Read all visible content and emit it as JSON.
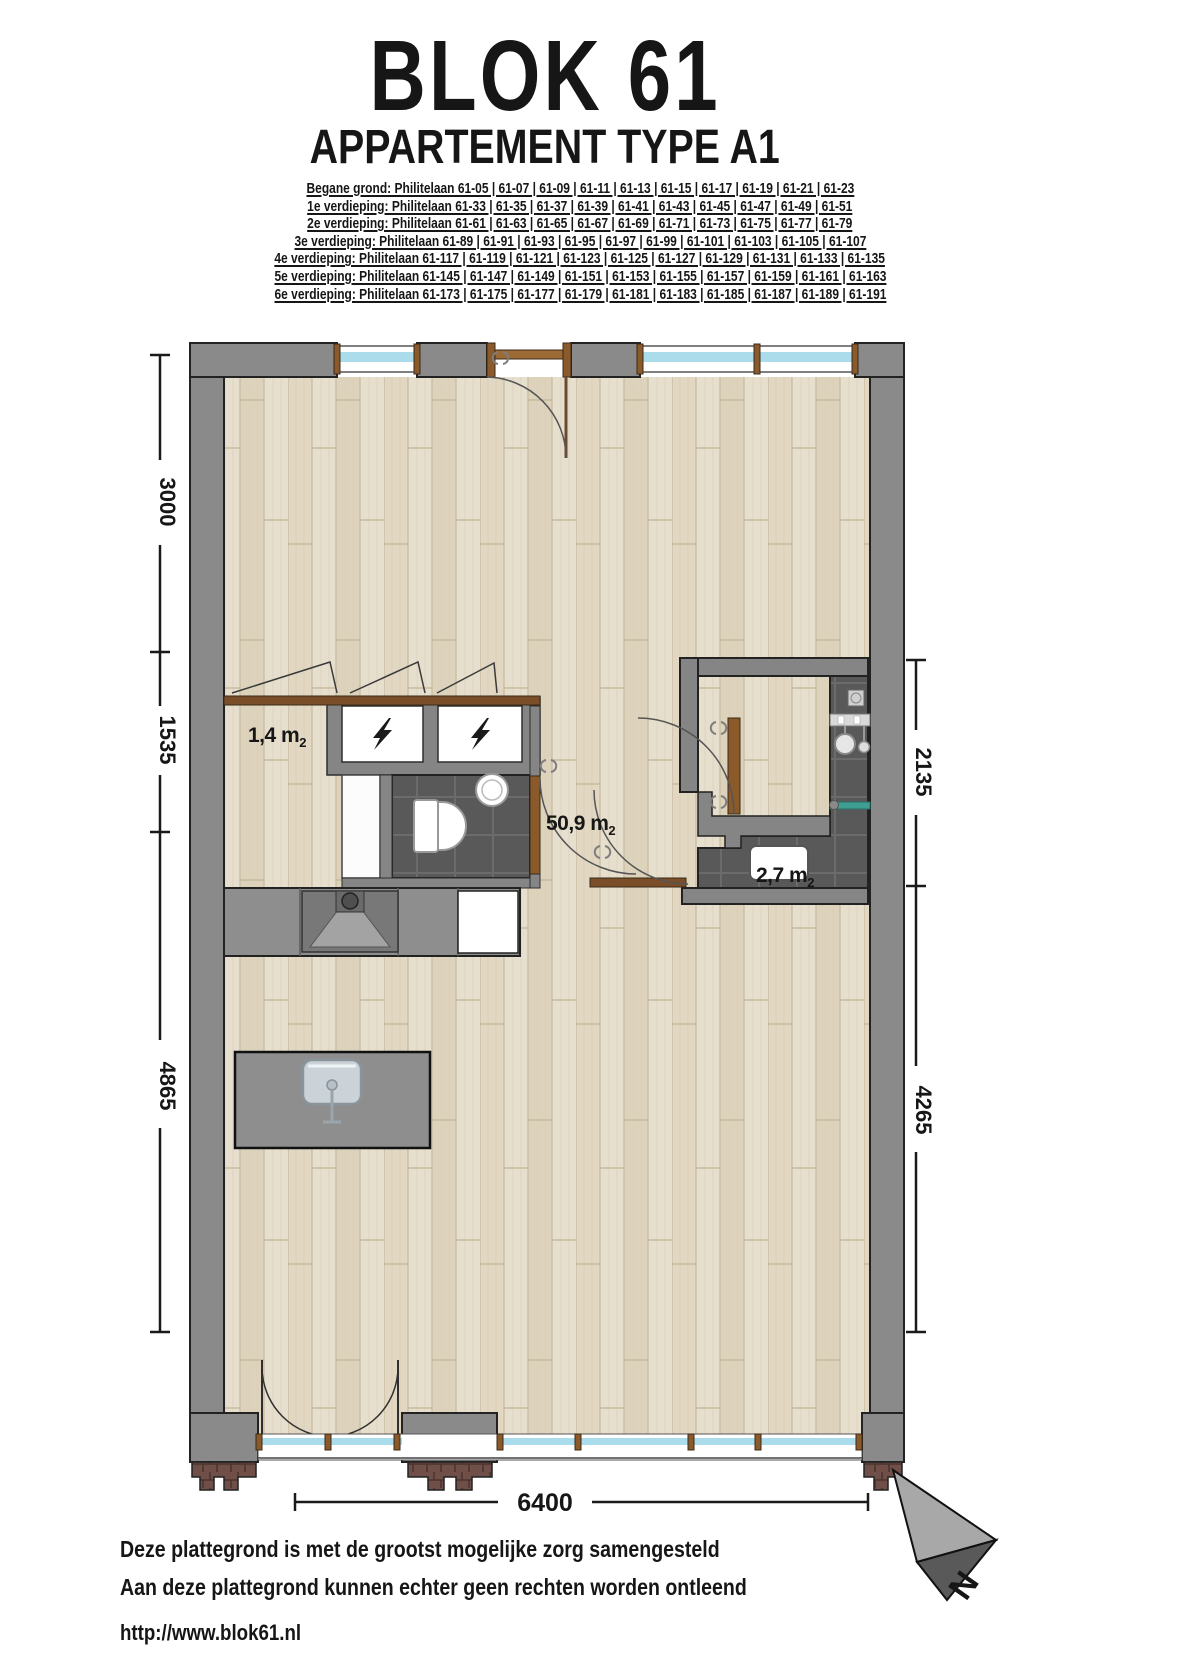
{
  "header": {
    "title": "BLOK 61",
    "subtitle": "APPARTEMENT TYPE A1",
    "address_lines": [
      "Begane grond: Philitelaan 61-05 | 61-07 | 61-09 | 61-11 | 61-13 | 61-15 | 61-17 | 61-19 | 61-21 | 61-23",
      "1e verdieping: Philitelaan 61-33 | 61-35 | 61-37 | 61-39 | 61-41 | 61-43 | 61-45 | 61-47 | 61-49 | 61-51",
      "2e verdieping: Philitelaan 61-61 | 61-63 | 61-65 | 61-67 | 61-69 | 61-71 | 61-73 | 61-75 | 61-77 | 61-79",
      "3e verdieping: Philitelaan 61-89 | 61-91 | 61-93 | 61-95 | 61-97 | 61-99 | 61-101 | 61-103 | 61-105 | 61-107",
      "4e verdieping: Philitelaan 61-117 | 61-119 | 61-121 | 61-123 | 61-125 | 61-127 | 61-129 | 61-131 | 61-133 | 61-135",
      "5e verdieping: Philitelaan 61-145 | 61-147 | 61-149 | 61-151 | 61-153 | 61-155 | 61-157 | 61-159 | 61-161 | 61-163",
      "6e verdieping: Philitelaan 61-173 | 61-175 | 61-177 | 61-179 | 61-181 | 61-183 | 61-185 | 61-187 | 61-189 | 61-191"
    ]
  },
  "plan": {
    "rooms": [
      {
        "name": "berging",
        "area": "1,4 m",
        "sub": "2"
      },
      {
        "name": "woonkamer",
        "area": "50,9 m",
        "sub": "2"
      },
      {
        "name": "badkamer",
        "area": "2,7 m",
        "sub": "2"
      }
    ],
    "dimensions": {
      "left": [
        "3000",
        "1535",
        "4865"
      ],
      "right": [
        "2135",
        "4265"
      ],
      "bottom": [
        "6400"
      ]
    },
    "north_label": "N"
  },
  "footer": {
    "disclaimer_line1": "Deze plattegrond is met de grootst mogelijke zorg samengesteld",
    "disclaimer_line2": "Aan deze plattegrond kunnen echter geen rechten worden ontleend",
    "website": "http://www.blok61.nl"
  },
  "icons": {
    "meter_cupboard": "lightning-icon",
    "compass": "north-arrow-icon"
  },
  "colors": {
    "wall_gray": "#8a8a8a",
    "floor_wood": "#e5dcc9",
    "tile_dark": "#595959",
    "glazing_blue": "#aadcec",
    "frame_brown": "#8a5a2b",
    "brick_red": "#6f4f47",
    "shower_glass_teal": "#3f9e92",
    "text_black": "#161616"
  }
}
